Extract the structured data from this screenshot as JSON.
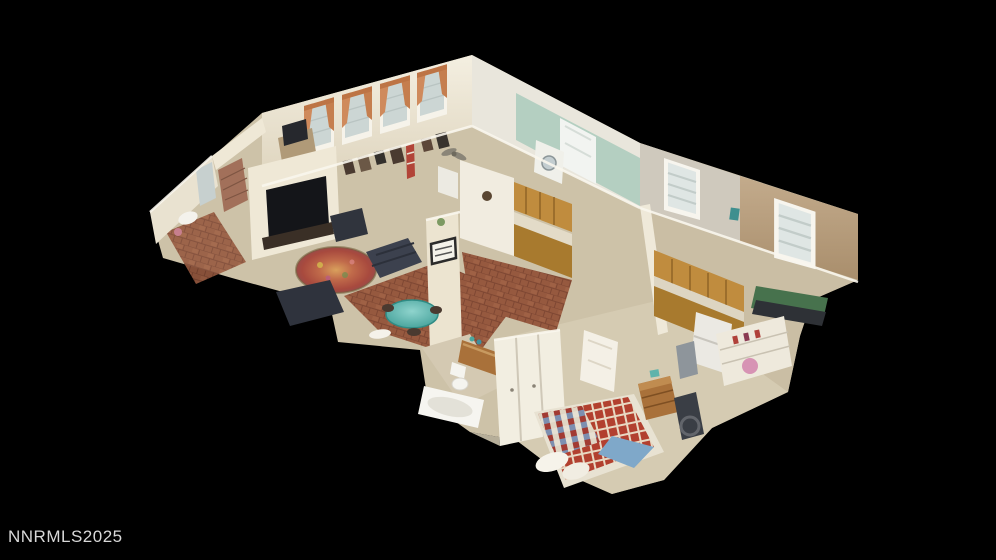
{
  "watermark": {
    "text": "NNRMLS2025"
  },
  "scene": {
    "type": "3d-dollhouse-floorplan-view",
    "background": "#000000",
    "rooms_visible": [
      "living room",
      "dining area",
      "main kitchen",
      "laundry room",
      "hall bathroom",
      "master bathroom",
      "bedroom with quilt bed",
      "second kitchen (casita)",
      "casita bedroom",
      "office bedroom with curtained windows"
    ]
  },
  "colors": {
    "background": "#000000",
    "watermark": "#d8d8d8",
    "wall_cream": "#ece4d2",
    "wall_white": "#f4f0e4",
    "wall_mint": "#b4cfc1",
    "wall_tan": "#b89e7e",
    "floor_carpet": "#cdc2a8",
    "floor_tile_terracotta": "#96593f",
    "cabinet_oak": "#c08c3e",
    "curtain_peach": "#cf8a5c",
    "table_teal": "#57b9b1",
    "quilt_red": "#b04434",
    "blanket_blue": "#7fa8c9",
    "sofa_charcoal": "#3c414e",
    "bed_green": "#47724d"
  }
}
